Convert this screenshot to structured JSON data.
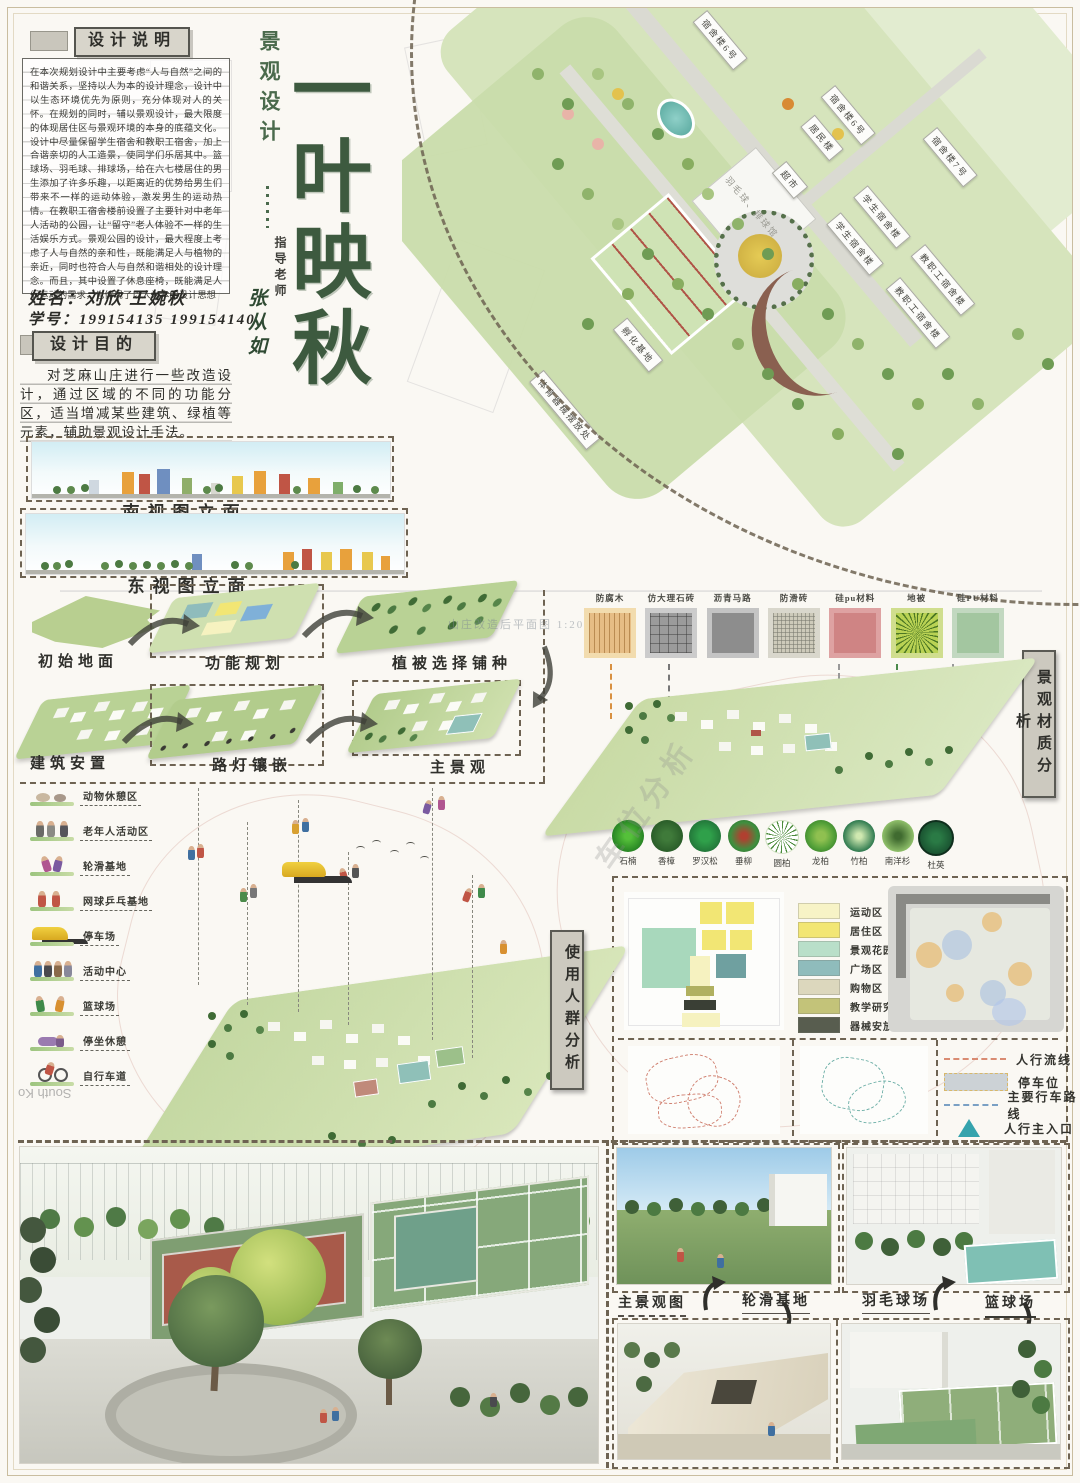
{
  "design_note": {
    "header": "设计说明",
    "body": "在本次规划设计中主要考虑“人与自然”之间的和谐关系，坚持以人为本的设计理念，设计中以生态环境优先为原则，充分体现对人的关怀。在规划的同时，辅以景观设计，最大限度的体现居住区与景观环境的本身的底蕴文化。设计中尽量保留学生宿舍和教职工宿舍，加上合谐亲切的人工造景，使同学们乐居其中。篮球场、羽毛球、排球场，给在六七楼居住的男生添加了许多乐趣，以距离近的优势给男生们带来不一样的运动体验，激发男生的运动热情。在教职工宿舍楼前设置了主要针对中老年人活动的公园，让“留守”老人体验不一样的生活娱乐方式。景观公园的设计，最大程度上考虑了人与自然的亲和性，既能满足人与植物的亲近，同时也符合人与自然和谐相处的设计理念。而且，其中设置了休息座椅，既能满足人们运动的需求，也体现了以人为本的设计思想"
  },
  "author": {
    "name_label": "姓名：",
    "names": "刘欣  王婉秋",
    "id_label": "学号：",
    "ids": "199154135   199154140"
  },
  "purpose": {
    "header": "设计目的",
    "body": "对芝麻山庄进行一些改造设计，通过区域的不同的功能分区，适当增减某些建筑、绿植等元素，辅助景观设计手法。"
  },
  "title": {
    "category": "景观设计",
    "main": "一叶映秋",
    "advisor_label": "指导老师",
    "advisor": "张从如"
  },
  "masterplan": {
    "caption": "山庄改造后平面图 1:2000",
    "buildings": [
      "宿舍楼6号",
      "宿舍楼6号",
      "居民楼",
      "宿舍楼7号",
      "超市",
      "羽毛球、排球馆",
      "学生宿舍楼",
      "学生宿舍楼",
      "教职工宿舍楼",
      "教职工宿舍楼",
      "孵化基地",
      "体育器械摆放处"
    ]
  },
  "elevations": {
    "south": "南视图立面",
    "east": "东视图立面"
  },
  "process": {
    "steps": [
      "初始地面",
      "功能规划",
      "植被选择铺种",
      "建筑安置",
      "路灯镶嵌",
      "主景观"
    ]
  },
  "materials": {
    "panel_label": "景观材质分析",
    "items": [
      {
        "label": "防腐木",
        "color": "#e6bd85"
      },
      {
        "label": "仿大理石砖",
        "color": "#9b9b9b"
      },
      {
        "label": "沥青马路",
        "color": "#8d8d8d"
      },
      {
        "label": "防滑砖",
        "color": "#cdcaba"
      },
      {
        "label": "硅pu材料",
        "color": "#cf8484"
      },
      {
        "label": "地被",
        "color": "#b9d254"
      },
      {
        "label": "硅PU材料",
        "color": "#a3c6a0"
      }
    ]
  },
  "plants": {
    "items": [
      "石楠",
      "香樟",
      "罗汉松",
      "垂柳",
      "圆柏",
      "龙柏",
      "竹柏",
      "南洋杉",
      "杜英"
    ]
  },
  "zones": {
    "items": [
      {
        "label": "运动区",
        "color": "#f7f3c6"
      },
      {
        "label": "居住区",
        "color": "#f2e674"
      },
      {
        "label": "景观花园区",
        "color": "#b9dfc9"
      },
      {
        "label": "广场区",
        "color": "#8fbcbc"
      },
      {
        "label": "购物区",
        "color": "#dcd7bd"
      },
      {
        "label": "教学研究区",
        "color": "#c3c379"
      },
      {
        "label": "器械安放区",
        "color": "#585d4f"
      }
    ]
  },
  "flow_legend": {
    "items": [
      {
        "label": "人行流线",
        "color": "#d98b72"
      },
      {
        "label": "停车位",
        "color": "#ccd2d6"
      },
      {
        "label": "主要行车路线",
        "color": "#7aa0c4"
      },
      {
        "label": "人行主入口",
        "color": "#35a3ad"
      }
    ]
  },
  "user_groups": {
    "panel_label": "使用人群分析",
    "items": [
      "动物休憩区",
      "老年人活动区",
      "轮滑基地",
      "网球乒乓基地",
      "停车场",
      "活动中心",
      "篮球场",
      "停坐休憩",
      "自行车道"
    ]
  },
  "bottom_gallery": {
    "labels": [
      "主景观图",
      "轮滑基地",
      "羽毛球场",
      "篮球场"
    ]
  },
  "watermarks": {
    "side": "South Ko",
    "diagonal": "车位分析"
  }
}
